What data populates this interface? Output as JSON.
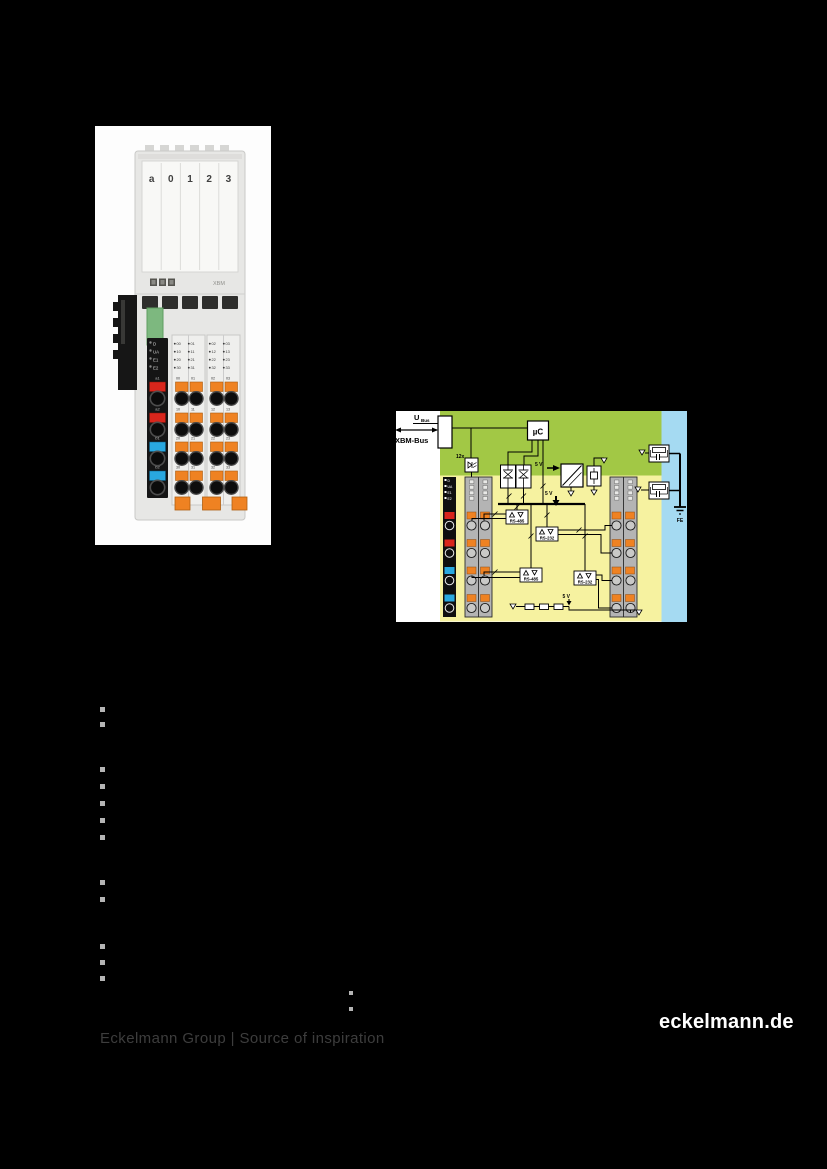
{
  "page": {
    "background": "#000000",
    "footer": {
      "left": "Eckelmann Group | Source of inspiration",
      "right": "eckelmann.de"
    }
  },
  "colors": {
    "accent_orange": "#ef8222",
    "clip_red": "#d9261c",
    "clip_blue": "#29a8e0",
    "diagram_logic_green": "#a2c845",
    "diagram_io_yellow": "#f6f2a0",
    "diagram_earth_blue": "#a5daf2",
    "bullet_gray": "#b5b5b5"
  },
  "photo": {
    "slot_labels": [
      "a",
      "0",
      "1",
      "2",
      "3"
    ],
    "module_type": "XBM",
    "led_labels": [
      "D",
      "UA",
      "E1",
      "E2"
    ],
    "port_labels": [
      "a1",
      "a2",
      "b1",
      "b2"
    ],
    "channel_labels": [
      [
        "00",
        "01",
        "02",
        "03"
      ],
      [
        "10",
        "11",
        "12",
        "13"
      ],
      [
        "20",
        "21",
        "22",
        "23"
      ],
      [
        "30",
        "31",
        "32",
        "33"
      ]
    ]
  },
  "diagram": {
    "bus_voltage_label": "U",
    "bus_voltage_subscript": "Bus",
    "bus_label": "XBM-Bus",
    "mcu_label": "µC",
    "optocoupler_count": "12x",
    "supply_label": "5 V",
    "interface_labels": [
      "RS-485",
      "RS-232",
      "RS-485",
      "RS-232"
    ],
    "earth_label": "FE",
    "led_labels": [
      "D",
      "UA",
      "E1",
      "E2"
    ]
  }
}
